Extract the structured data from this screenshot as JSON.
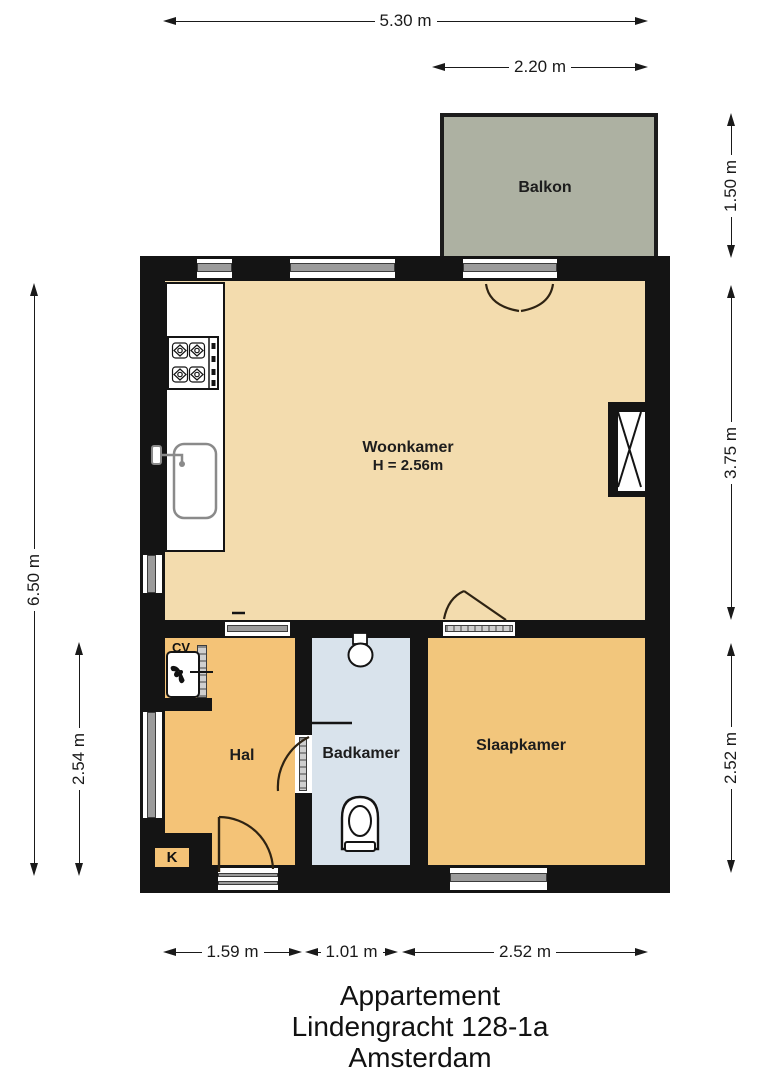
{
  "title": {
    "line1": "Appartement",
    "line2": "Lindengracht 128-1a",
    "line3": "Amsterdam"
  },
  "rooms": {
    "balkon": {
      "label": "Balkon"
    },
    "woonkamer": {
      "label": "Woonkamer",
      "height_note": "H = 2.56m"
    },
    "hal": {
      "label": "Hal"
    },
    "badkamer": {
      "label": "Badkamer"
    },
    "slaapkamer": {
      "label": "Slaapkamer"
    },
    "cv": {
      "label": "CV"
    },
    "kast": {
      "label": "K"
    }
  },
  "dimensions": {
    "top_total": "5.30 m",
    "balcony_width": "2.20 m",
    "balcony_depth": "1.50 m",
    "woonkamer_depth": "3.75 m",
    "slaapkamer_depth_right": "2.52 m",
    "left_total": "6.50 m",
    "hal_depth": "2.54 m",
    "hal_width": "1.59 m",
    "badkamer_width": "1.01 m",
    "slaapkamer_width": "2.52 m"
  },
  "colors": {
    "wall": "#141414",
    "woonkamer": "#f3dcae",
    "hal": "#f4c377",
    "slaapkamer": "#f2c67c",
    "badkamer": "#d9e3ec",
    "balkon": "#adb1a2",
    "window_glass": "#9b9b9b"
  }
}
